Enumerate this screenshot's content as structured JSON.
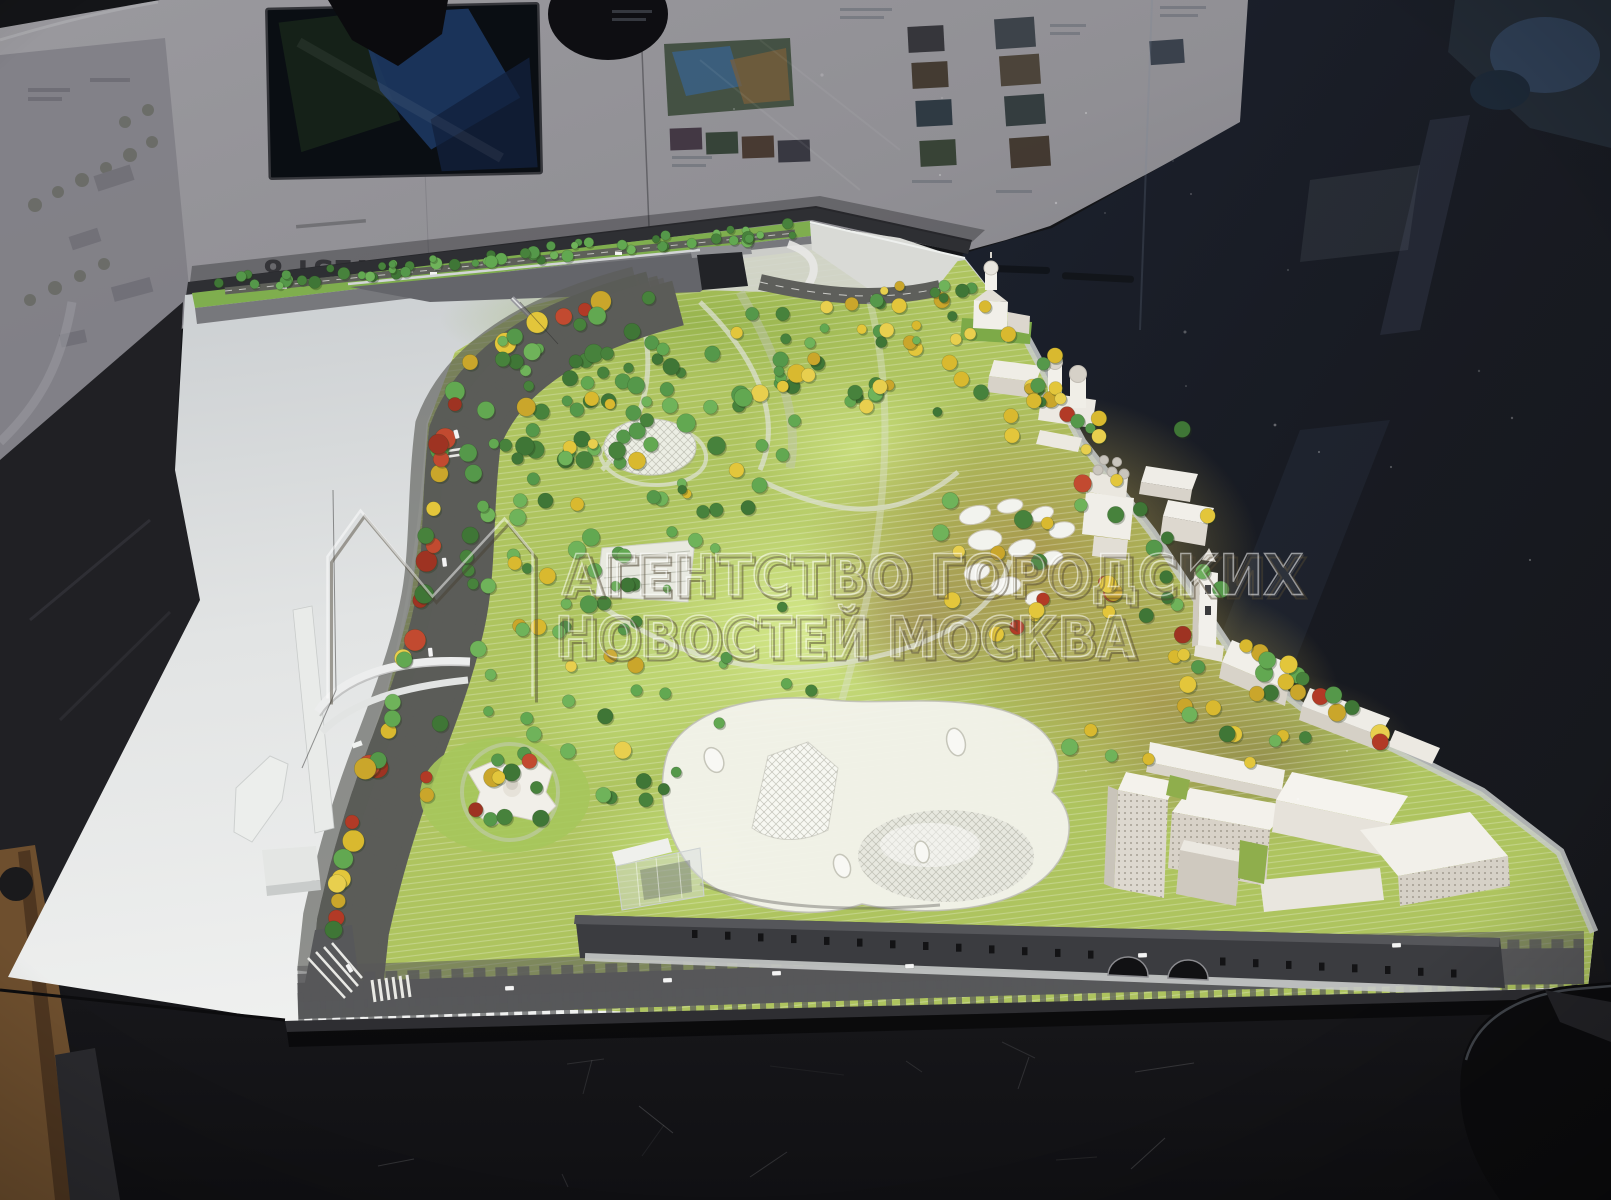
{
  "scene": {
    "description": "Photograph of an architectural scale model of a riverside park in a glass display case with presentation boards behind",
    "watermark": {
      "line1": "АГЕНТСТВО ГОРОДСКИХ",
      "line2": "НОВОСТЕЙ МОСКВА",
      "logo": "m-outline-logo"
    },
    "board": {
      "title_rotated": "WEST 8"
    }
  },
  "palette": {
    "table": "#1a1a1d",
    "board_gray": "#97969b",
    "dark_glass": "#16171b",
    "river": "#e9ebea",
    "grass": "#aec45f",
    "grass_bright": "#d4e88a",
    "tan_ground": "#a8964c",
    "road": "#5b5c58",
    "road_marking": "#efefeb",
    "embankment_wall": "#3b3c40",
    "building_white": "#f2f0ea",
    "building_shade": "#d8d3c9",
    "canopy": "#f2f2eb",
    "tree_greens": [
      "#47823c",
      "#55984a",
      "#62a851",
      "#6fb35a",
      "#3f7636"
    ],
    "tree_yellows": [
      "#d9b92f",
      "#e3c63b",
      "#caa62b",
      "#e8cf4e"
    ],
    "tree_reds": [
      "#b23a26",
      "#c24a30",
      "#9e3322"
    ]
  }
}
